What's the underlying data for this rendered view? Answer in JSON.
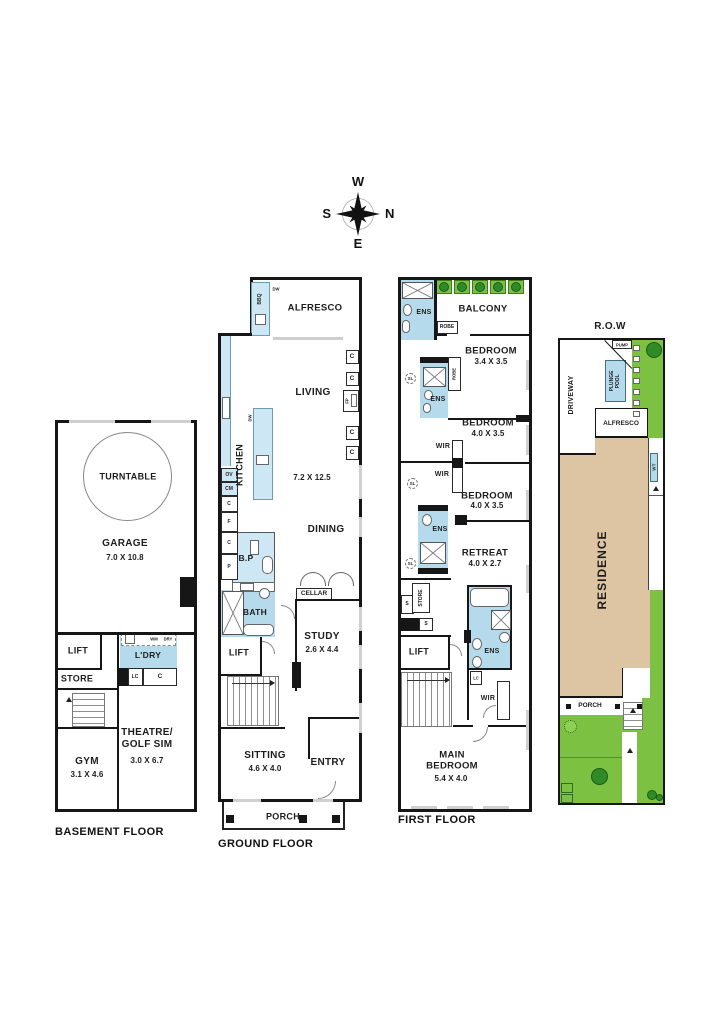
{
  "page": {
    "background": "#ffffff",
    "type": "architectural floor plan set"
  },
  "colors": {
    "wall": "#161616",
    "wet_area_blue": "#b5daec",
    "joinery_blue": "#cde7f4",
    "garden_green": "#7cc142",
    "tree_green": "#2f8b28",
    "residence_tan": "#ddc5a4",
    "window_grey": "#cfcfcf"
  },
  "compass": {
    "west": "W",
    "north": "N",
    "south": "S",
    "east": "E"
  },
  "abbr": {
    "c": "C",
    "f": "F",
    "p": "P",
    "ov": "OV",
    "cm": "CM",
    "fp": "FP",
    "dw": "DW",
    "bbq": "BBQ",
    "wm": "WM",
    "dry": "DRY",
    "lc": "LC",
    "s": "S",
    "sl": "SL",
    "wt": "WT",
    "ens": "ENS",
    "wir": "WIR",
    "robe": "ROBE",
    "lift": "LIFT",
    "store": "STORE",
    "porch": "PORCH",
    "alfresco": "ALFRESCO",
    "pump": "PUMP"
  },
  "plans": {
    "basement": {
      "floor_label": "BASEMENT FLOOR",
      "turntable": "TURNTABLE",
      "garage": "GARAGE",
      "garage_dim": "7.0 X 10.8",
      "ldry": "L'DRY",
      "gym": "GYM",
      "gym_dim": "3.1 X 4.6",
      "theatre": "THEATRE/\nGOLF SIM",
      "theatre_dim": "3.0 X 6.7"
    },
    "ground": {
      "floor_label": "GROUND FLOOR",
      "living": "LIVING",
      "living_dining_dim": "7.2 X 12.5",
      "dining": "DINING",
      "kitchen": "KITCHEN",
      "bp": "B.P",
      "bath": "BATH",
      "cellar": "CELLAR",
      "study": "STUDY",
      "study_dim": "2.6 X 4.4",
      "sitting": "SITTING",
      "sitting_dim": "4.6 X 4.0",
      "entry": "ENTRY"
    },
    "first": {
      "floor_label": "FIRST FLOOR",
      "balcony": "BALCONY",
      "bedroom": "BEDROOM",
      "bedroom1_dim": "3.4 X 3.5",
      "bedroom2_dim": "4.0 X 3.5",
      "bedroom3_dim": "4.0 X 3.5",
      "retreat": "RETREAT",
      "retreat_dim": "4.0 X 2.7",
      "main_bedroom": "MAIN\nBEDROOM",
      "main_bedroom_dim": "5.4 X 4.0"
    },
    "site": {
      "row": "R.O.W",
      "plunge_pool": "PLUNGE\nPOOL",
      "driveway": "DRIVEWAY",
      "residence": "RESIDENCE"
    }
  }
}
